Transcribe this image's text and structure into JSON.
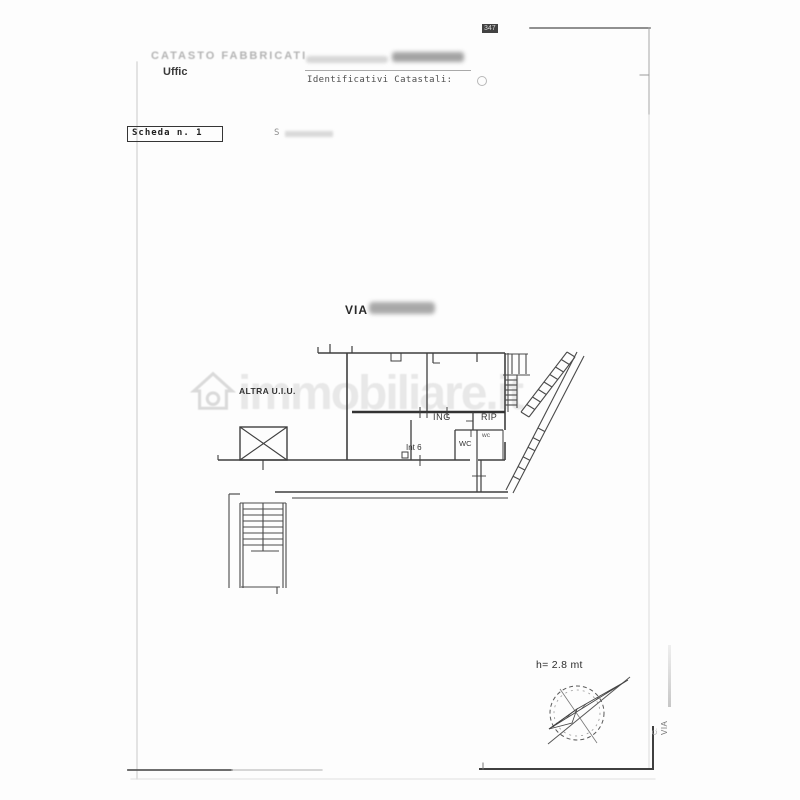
{
  "header": {
    "page_mark": "347",
    "title": "CATASTO FABBRICATI",
    "office": "Uffic",
    "identifiers_label": "Identificativi Catastali:"
  },
  "scheda": {
    "label": "Scheda n. 1",
    "scale_prefix": "S"
  },
  "plan": {
    "street": "VIA",
    "labels": {
      "altra_uiu": "ALTRA U.I.U.",
      "ing": "ING",
      "rip": "RIP",
      "wc": "WC",
      "wc_small": "wc",
      "int6": "Int 6"
    },
    "height_note": "h= 2.8 mt"
  },
  "side_text": {
    "line1": "C.",
    "line2": "VIA"
  },
  "watermark": "immobiliare.it",
  "colors": {
    "ink": "#3f3f3f",
    "faint": "#d2d2d2",
    "watermark": "rgba(80,80,80,0.12)"
  }
}
